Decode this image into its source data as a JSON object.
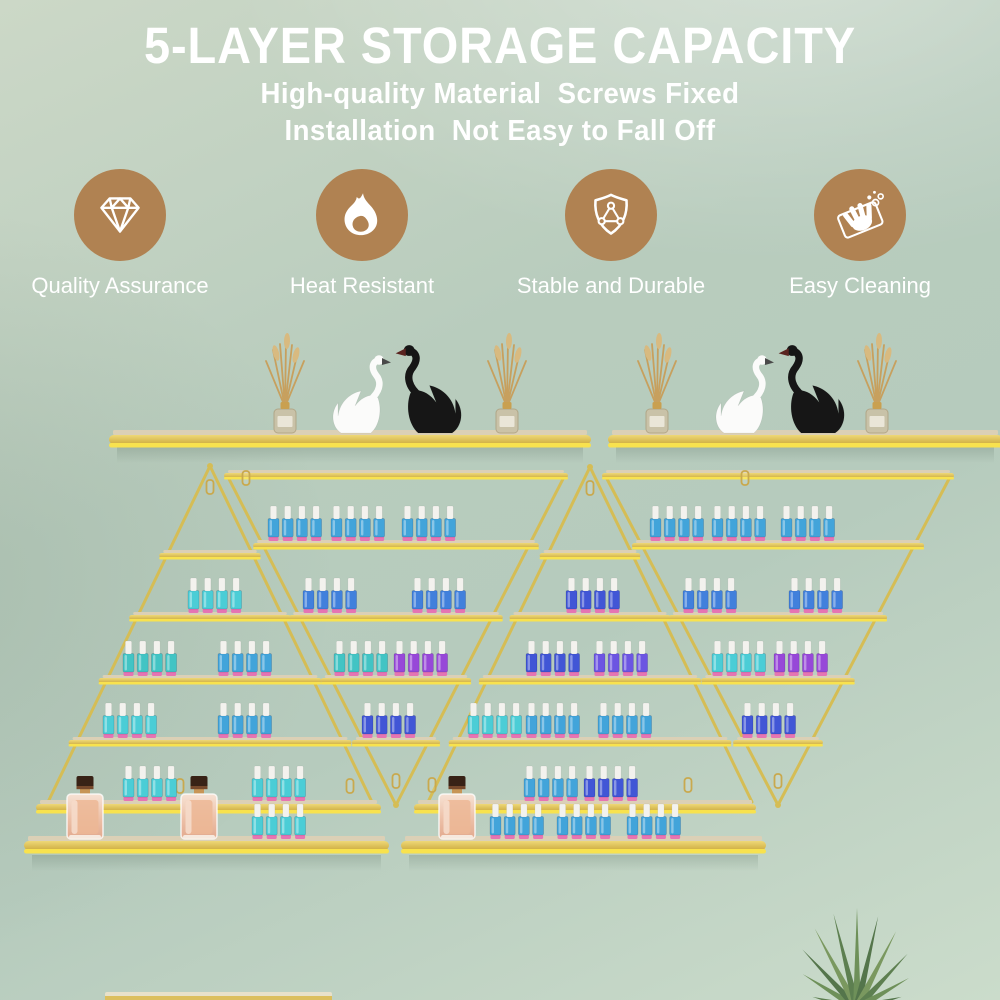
{
  "header": {
    "title": "5-LAYER STORAGE CAPACITY",
    "subtitle_line1": "High-quality Material  Screws Fixed",
    "subtitle_line2": "Installation  Not Easy to Fall Off"
  },
  "features": [
    {
      "icon": "diamond-icon",
      "label": "Quality Assurance",
      "center_x": 120
    },
    {
      "icon": "flame-icon",
      "label": "Heat Resistant",
      "center_x": 362
    },
    {
      "icon": "shield-icon",
      "label": "Stable and Durable",
      "center_x": 611
    },
    {
      "icon": "cleaning-icon",
      "label": "Easy Cleaning",
      "center_x": 860
    }
  ],
  "colors": {
    "icon_circle": "#b08252",
    "text": "#ffffff",
    "background_base": "#b7cbbc",
    "gold_strut": "#d5bd55",
    "gold_bright": "#f8e24e",
    "shelf_top_band": "#dbd0b6",
    "hanger_gold": "#c9a94e"
  },
  "scene": {
    "bottle_palette": {
      "cyan": "#4bcdd6",
      "teal": "#42c4c4",
      "skyblue": "#42a4da",
      "blue": "#4180dc",
      "indigo": "#4156d6",
      "violet": "#9748d8",
      "blueviolet": "#6c55e2"
    },
    "bottle_parts": {
      "cap": "#f3f2ee",
      "foot": "#e770b2"
    },
    "racks": [
      {
        "name": "left-pyramid-rack",
        "type": "upright",
        "cx": 210,
        "apex_y": 466,
        "base_y": 800,
        "half_base": 162,
        "shelves": [
          {
            "y": 550,
            "groups": []
          },
          {
            "y": 612,
            "groups": [
              {
                "x": 188,
                "n": 4,
                "color": "cyan"
              }
            ]
          },
          {
            "y": 675,
            "groups": [
              {
                "x": 123,
                "n": 4,
                "color": "teal"
              },
              {
                "x": 218,
                "n": 4,
                "color": "skyblue"
              }
            ]
          },
          {
            "y": 737,
            "groups": [
              {
                "x": 103,
                "n": 4,
                "color": "cyan"
              },
              {
                "x": 218,
                "n": 4,
                "color": "skyblue"
              }
            ]
          }
        ]
      },
      {
        "name": "middle-inverted-rack",
        "type": "inverted",
        "cx": 396,
        "top_y": 470,
        "tip_y": 805,
        "half_top": 168,
        "shelves": [
          {
            "y": 540,
            "groups": [
              {
                "x": 268,
                "n": 4,
                "color": "skyblue"
              },
              {
                "x": 331,
                "n": 4,
                "color": "skyblue"
              },
              {
                "x": 402,
                "n": 4,
                "color": "skyblue"
              }
            ]
          },
          {
            "y": 612,
            "groups": [
              {
                "x": 303,
                "n": 4,
                "color": "blue"
              },
              {
                "x": 412,
                "n": 4,
                "color": "blue"
              }
            ]
          },
          {
            "y": 675,
            "groups": [
              {
                "x": 334,
                "n": 4,
                "color": "teal"
              },
              {
                "x": 394,
                "n": 4,
                "color": "violet"
              }
            ]
          },
          {
            "y": 737,
            "groups": [
              {
                "x": 362,
                "n": 4,
                "color": "indigo"
              }
            ]
          }
        ]
      },
      {
        "name": "right-pyramid-rack",
        "type": "upright",
        "cx": 590,
        "apex_y": 467,
        "base_y": 800,
        "half_base": 162,
        "shelves": [
          {
            "y": 550,
            "groups": []
          },
          {
            "y": 612,
            "groups": [
              {
                "x": 566,
                "n": 4,
                "color": "indigo"
              }
            ]
          },
          {
            "y": 675,
            "groups": [
              {
                "x": 526,
                "n": 4,
                "color": "indigo"
              },
              {
                "x": 594,
                "n": 4,
                "color": "blueviolet"
              }
            ]
          },
          {
            "y": 737,
            "groups": [
              {
                "x": 468,
                "n": 4,
                "color": "cyan"
              },
              {
                "x": 526,
                "n": 4,
                "color": "skyblue"
              },
              {
                "x": 598,
                "n": 4,
                "color": "skyblue"
              }
            ]
          }
        ]
      },
      {
        "name": "right-inverted-rack",
        "type": "inverted",
        "cx": 778,
        "top_y": 470,
        "tip_y": 805,
        "half_top": 172,
        "shelves": [
          {
            "y": 540,
            "groups": [
              {
                "x": 650,
                "n": 4,
                "color": "skyblue"
              },
              {
                "x": 712,
                "n": 4,
                "color": "skyblue"
              },
              {
                "x": 781,
                "n": 4,
                "color": "skyblue"
              }
            ]
          },
          {
            "y": 612,
            "groups": [
              {
                "x": 683,
                "n": 4,
                "color": "blue"
              },
              {
                "x": 789,
                "n": 4,
                "color": "blue"
              }
            ]
          },
          {
            "y": 675,
            "groups": [
              {
                "x": 712,
                "n": 4,
                "color": "cyan"
              },
              {
                "x": 774,
                "n": 4,
                "color": "violet"
              }
            ]
          },
          {
            "y": 737,
            "groups": [
              {
                "x": 742,
                "n": 4,
                "color": "indigo"
              }
            ]
          }
        ]
      }
    ],
    "wall_shelves_top": [
      {
        "x1": 113,
        "x2": 587,
        "y": 430,
        "diffusers": [
          285,
          507
        ],
        "swans_cx": 395
      },
      {
        "x1": 612,
        "x2": 998,
        "y": 430,
        "diffusers": [
          657,
          877
        ],
        "swans_cx": 778
      }
    ],
    "wall_shelves_bottom": [
      {
        "side": "left",
        "upper": {
          "x1": 40,
          "x2": 377,
          "y": 800,
          "groups": [
            {
              "x": 123,
              "n": 4,
              "color": "cyan"
            },
            {
              "x": 252,
              "n": 4,
              "color": "cyan"
            }
          ]
        },
        "lower": {
          "x1": 28,
          "x2": 385,
          "y": 836,
          "perfumes": [
            85,
            199
          ],
          "groups": [
            {
              "x": 252,
              "n": 4,
              "color": "cyan"
            }
          ]
        }
      },
      {
        "side": "right",
        "upper": {
          "x1": 418,
          "x2": 752,
          "y": 800,
          "groups": [
            {
              "x": 524,
              "n": 4,
              "color": "skyblue"
            },
            {
              "x": 584,
              "n": 4,
              "color": "indigo"
            }
          ]
        },
        "lower": {
          "x1": 405,
          "x2": 762,
          "y": 836,
          "perfumes": [
            457
          ],
          "groups": [
            {
              "x": 490,
              "n": 4,
              "color": "skyblue"
            },
            {
              "x": 557,
              "n": 4,
              "color": "skyblue"
            },
            {
              "x": 627,
              "n": 4,
              "color": "skyblue"
            }
          ]
        }
      }
    ],
    "hangers": [
      [
        210,
        487
      ],
      [
        590,
        488
      ],
      [
        246,
        478
      ],
      [
        745,
        478
      ],
      [
        396,
        781
      ],
      [
        778,
        781
      ],
      [
        180,
        786
      ],
      [
        350,
        786
      ],
      [
        432,
        785
      ],
      [
        688,
        785
      ]
    ],
    "plant": {
      "cx": 857,
      "base_y": 1008
    },
    "cabinet": {
      "x1": 105,
      "x2": 332,
      "y": 992
    }
  }
}
